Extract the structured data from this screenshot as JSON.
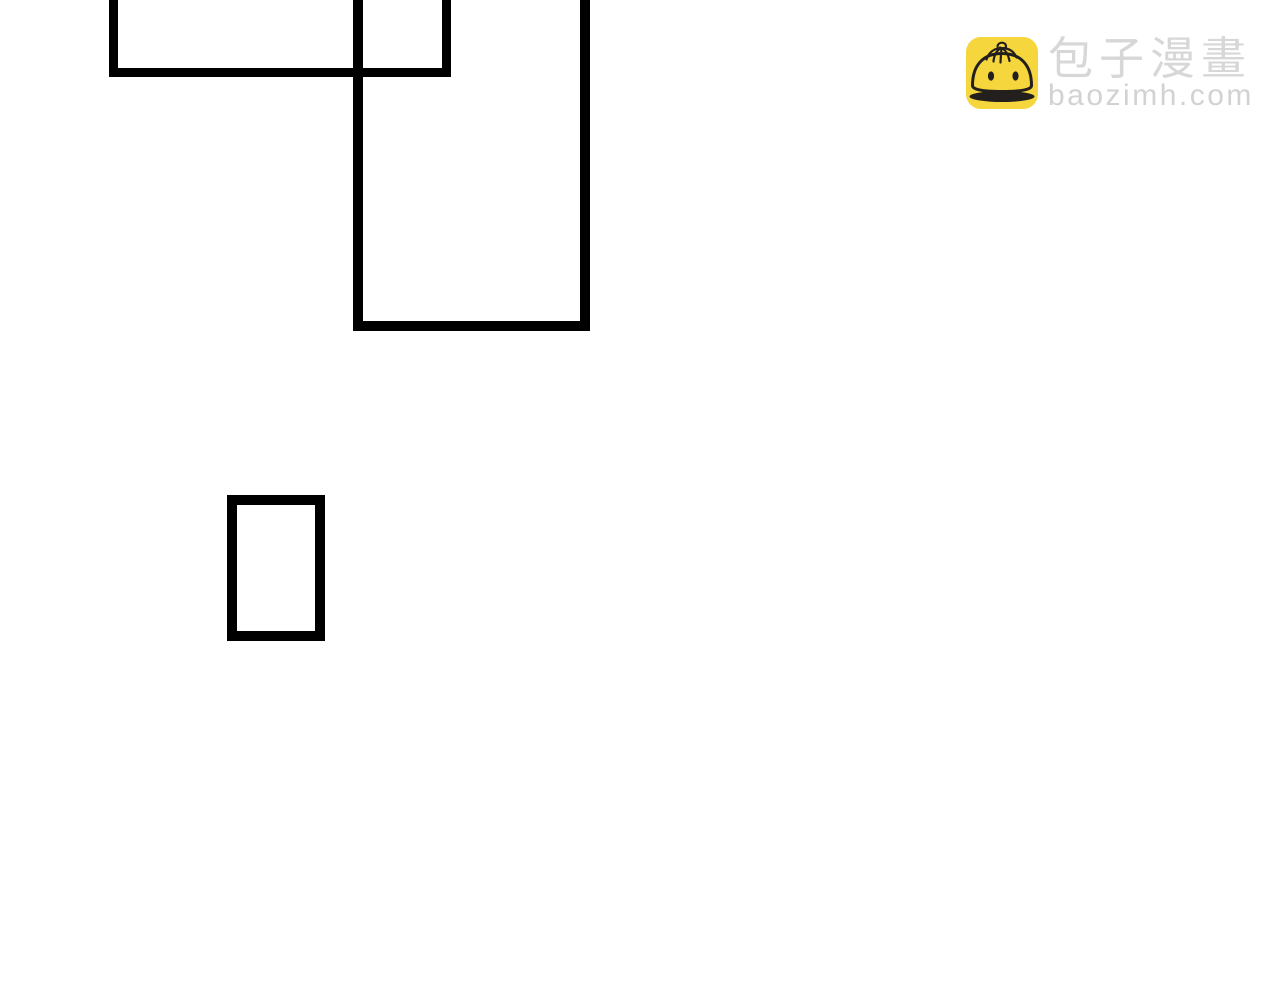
{
  "page": {
    "background_color": "#ffffff",
    "width": 1280,
    "height": 1000,
    "description": "blank comic/manga page region with empty panel outlines"
  },
  "comic": {
    "panel_border_color": "#000000",
    "panels": [
      {
        "id": "panel-top-left",
        "left": 109,
        "top": -24,
        "width": 342,
        "height": 101,
        "border": 9
      },
      {
        "id": "panel-tall",
        "left": 353,
        "top": -24,
        "width": 237,
        "height": 355,
        "border": 10
      },
      {
        "id": "panel-small",
        "left": 227,
        "top": 495,
        "width": 98,
        "height": 146,
        "border": 10
      }
    ]
  },
  "watermark": {
    "brand_name": "包子漫畫",
    "site_url": "baozimh.com",
    "icon": "baozi-bun-icon",
    "icon_bg_color": "#F5D63D",
    "icon_line_color": "#231f1c",
    "brand_text_color": "#D7D7D7",
    "url_text_color": "#D2D2D2"
  }
}
